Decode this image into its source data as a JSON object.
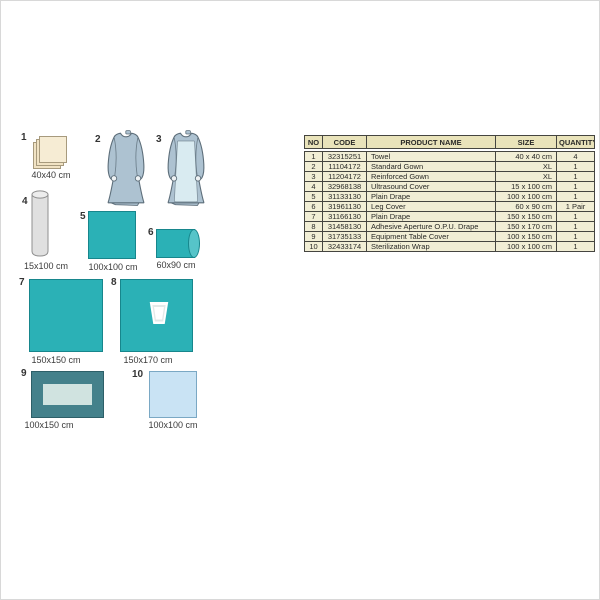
{
  "items": [
    {
      "number": "1",
      "size_label": "40x40 cm"
    },
    {
      "number": "2"
    },
    {
      "number": "3"
    },
    {
      "number": "4",
      "size_label": "15x100 cm"
    },
    {
      "number": "5",
      "size_label": "100x100 cm"
    },
    {
      "number": "6",
      "size_label": "60x90 cm"
    },
    {
      "number": "7",
      "size_label": "150x150 cm"
    },
    {
      "number": "8",
      "size_label": "150x170 cm"
    },
    {
      "number": "9",
      "size_label": "100x150 cm"
    },
    {
      "number": "10",
      "size_label": "100x100 cm"
    }
  ],
  "table": {
    "headers": [
      "NO",
      "CODE",
      "PRODUCT NAME",
      "SIZE",
      "QUANTITY"
    ],
    "rows": [
      [
        "1",
        "32315251",
        "Towel",
        "40 x 40 cm",
        "4"
      ],
      [
        "2",
        "11104172",
        "Standard Gown",
        "XL",
        "1"
      ],
      [
        "3",
        "11204172",
        "Reinforced Gown",
        "XL",
        "1"
      ],
      [
        "4",
        "32968138",
        "Ultrasound Cover",
        "15 x 100 cm",
        "1"
      ],
      [
        "5",
        "31133130",
        "Plain Drape",
        "100 x 100 cm",
        "1"
      ],
      [
        "6",
        "31961130",
        "Leg Cover",
        "60 x 90 cm",
        "1 Pair"
      ],
      [
        "7",
        "31166130",
        "Plain Drape",
        "150 x 150 cm",
        "1"
      ],
      [
        "8",
        "31458130",
        "Adhesive Aperture O.P.U. Drape",
        "150 x 170 cm",
        "1"
      ],
      [
        "9",
        "31735133",
        "Equipment Table Cover",
        "100 x 150 cm",
        "1"
      ],
      [
        "10",
        "32433174",
        "Sterilization Wrap",
        "100 x 100 cm",
        "1"
      ]
    ]
  },
  "colors": {
    "teal": "#2bb1b6",
    "teal_border": "#17868c",
    "teal_end": "#56c4c9",
    "dark_teal": "#44818b",
    "dark_teal_border": "#2d5f68",
    "light_panel": "#d0e3e0",
    "light_blue": "#c9e3f4",
    "light_blue_border": "#7aa8c4",
    "cream": "#f6ecd4",
    "cream_back": "#f1e3c4",
    "cream_border": "#a79a7d",
    "gray_fill": "#e0e0e0",
    "gray_top": "#ededed",
    "gray_border": "#8f8f8f",
    "gown": "#adc2d1",
    "gown_outline": "#5d6e7a",
    "gown_panel": "#d9ebf1",
    "hand_fill": "#eef2f4",
    "aperture_gray": "#e3e9e8",
    "table_header_bg": "#e9e3ba",
    "table_row_bg": "#f1eed5",
    "table_border": "#454540"
  }
}
